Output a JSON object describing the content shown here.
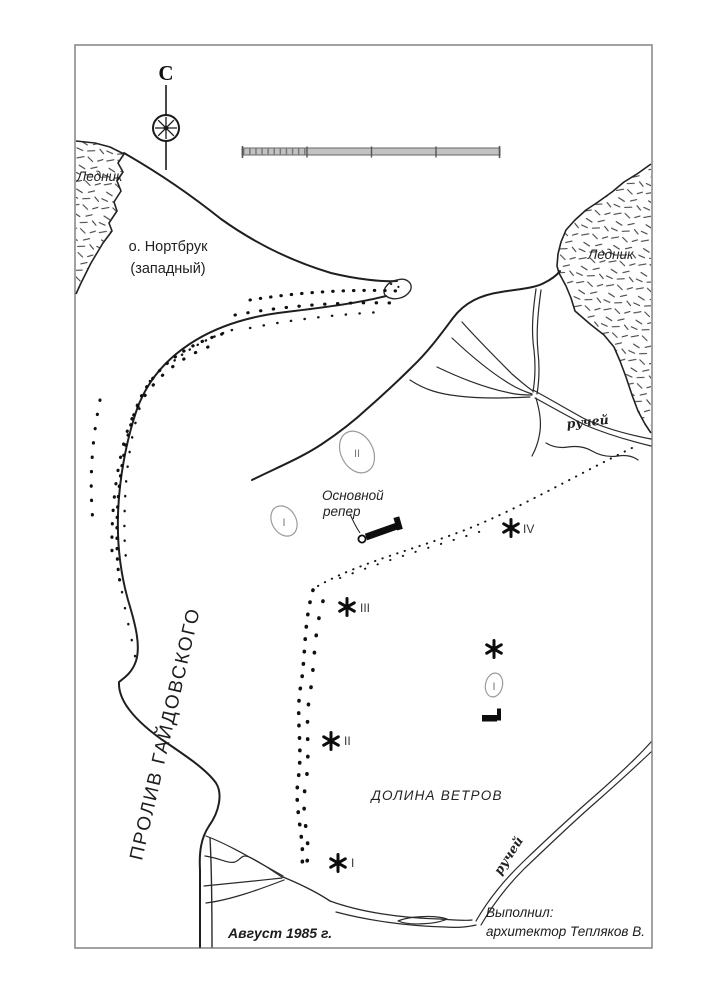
{
  "map": {
    "compass_north": "С",
    "glacier_left_label": "Ледник",
    "glacier_right_label": "Ледник",
    "island_name_line1": "о. Нортбрук",
    "island_name_line2": "(западный)",
    "strait_label": "ПРОЛИВ ГАЙДОВСКОГО",
    "valley_label": "ДОЛИНА ВЕТРОВ",
    "stream_upper_label": "ручей",
    "stream_lower_label": "ручей",
    "benchmark_label_line1": "Основной",
    "benchmark_label_line2": "репер",
    "date_label": "Август 1985 г.",
    "credit_line1": "Выполнил:",
    "credit_line2": "архитектор Тепляков В.",
    "markers": {
      "i": "I",
      "ii": "II",
      "iii": "III",
      "iv": "IV"
    },
    "lakes": {
      "upper": "II",
      "lower": "I",
      "small": "I"
    },
    "colors": {
      "ink": "#1f1f1f",
      "lake_outline": "#9a9a9a",
      "scalebar_fill": "#c2c2c2"
    }
  }
}
